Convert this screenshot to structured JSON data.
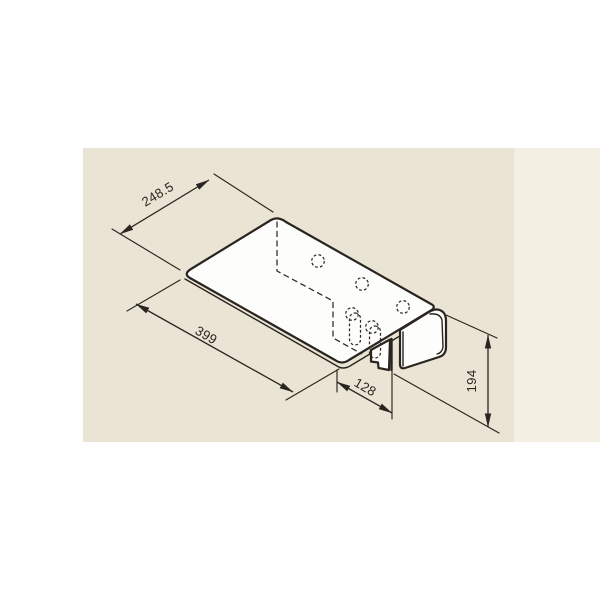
{
  "title": "Isometric dimensioned drawing of a bent sheet-metal bracket",
  "colors": {
    "page_bg": "#ffffff",
    "panel_bg": "#eae4d4",
    "panel_strip": "#f3efe3",
    "line": "#2a2520"
  },
  "dimensions": {
    "top_edge": "248.5",
    "front_edge": "399",
    "tab_offset": "128",
    "height": "194"
  }
}
